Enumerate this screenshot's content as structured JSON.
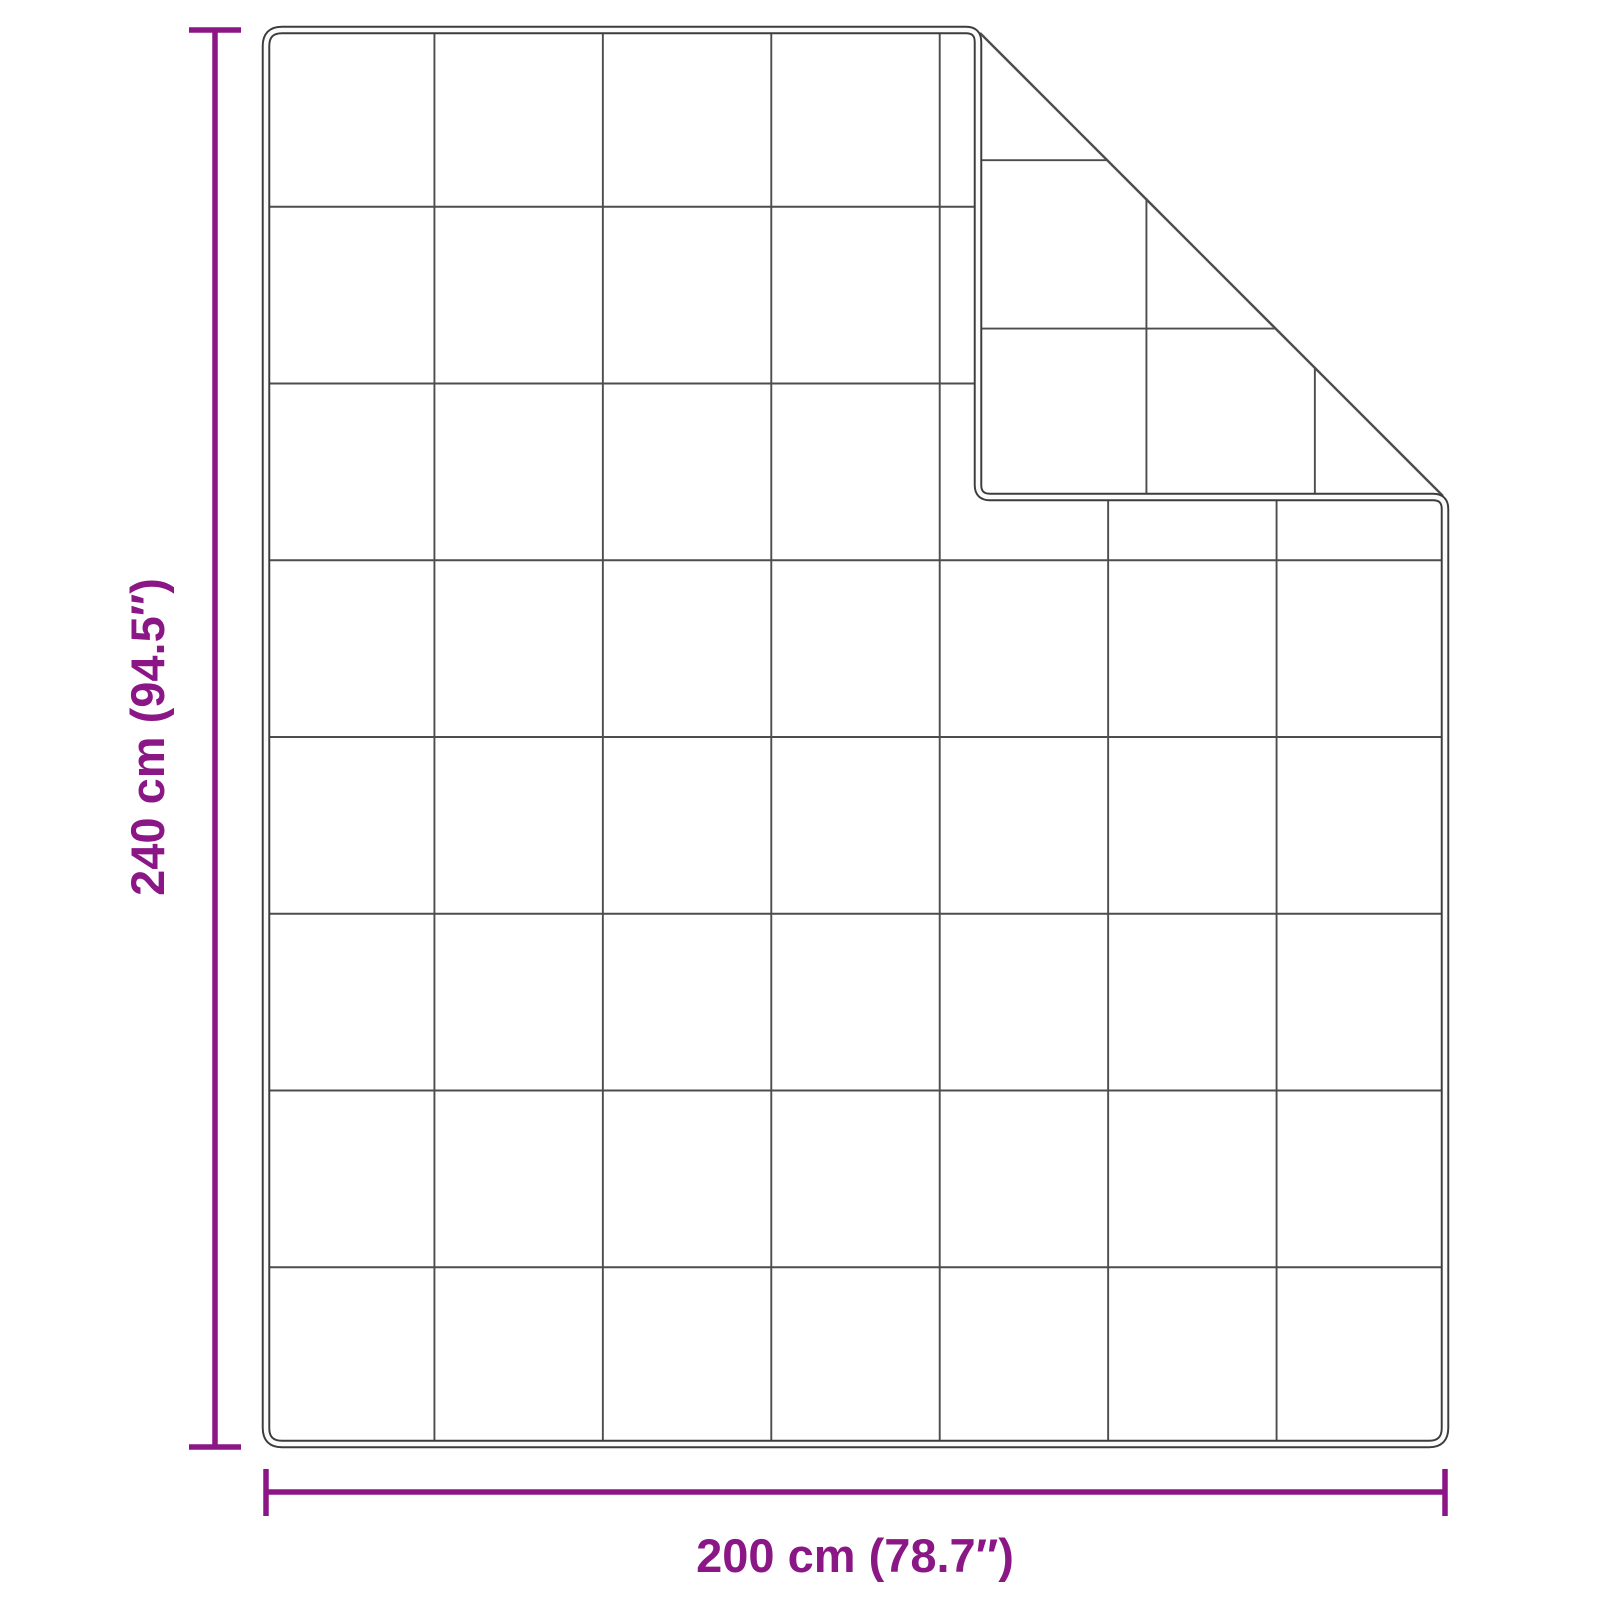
{
  "diagram": {
    "type": "product-dimension-diagram",
    "subject": "quilted blanket with folded-over top-right corner",
    "height_label": "240 cm (94.5″)",
    "width_label": "200 cm (78.7″)",
    "grid": {
      "columns": 7,
      "rows": 8
    },
    "colors": {
      "dimension_accent": "#8B1786",
      "outline": "#3C3C3C",
      "grid_line": "#4D4D4D",
      "background": "#FFFFFF"
    }
  }
}
